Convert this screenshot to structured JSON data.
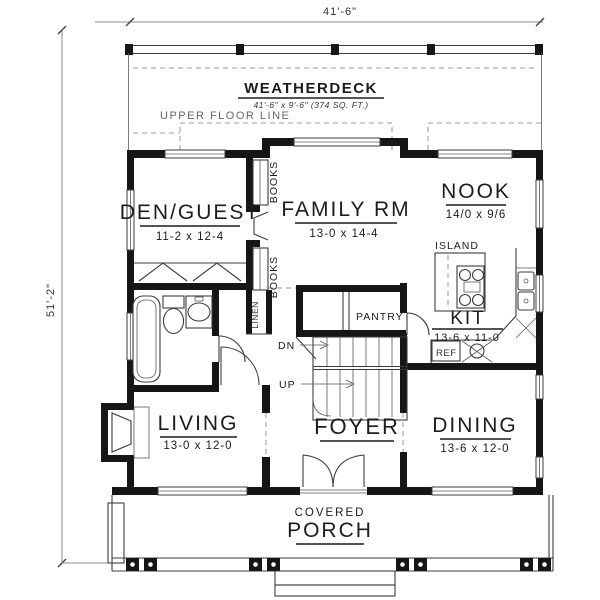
{
  "plan": {
    "dim_width": "41'-6\"",
    "dim_height": "51'-2\"",
    "deck": {
      "title": "WEATHERDECK",
      "size": "41'-6\" x 9'-6\" (374 SQ. FT.)"
    },
    "upper_floor_line": "UPPER FLOOR LINE",
    "rooms": {
      "den": {
        "name": "DEN/GUEST",
        "size": "11-2 x 12-4"
      },
      "family": {
        "name": "FAMILY RM",
        "size": "13-0 x 14-4"
      },
      "nook": {
        "name": "NOOK",
        "size": "14/0 x 9/6"
      },
      "kitchen": {
        "name": "KIT",
        "size": "13-6 x 11-0"
      },
      "living": {
        "name": "LIVING",
        "size": "13-0 x 12-0"
      },
      "foyer": {
        "name": "FOYER"
      },
      "dining": {
        "name": "DINING",
        "size": "13-6 x 12-0"
      },
      "porch": {
        "line1": "COVERED",
        "line2": "PORCH"
      }
    },
    "features": {
      "island": "ISLAND",
      "pantry": "PANTRY",
      "linen": "LINEN",
      "books_upper": "BOOKS",
      "books_lower": "BOOKS",
      "ref": "REF",
      "dn": "DN",
      "up": "UP"
    },
    "colors": {
      "wall": "#161616",
      "line": "#3c3c3c",
      "dashed": "#9a9a9a",
      "background": "#ffffff"
    }
  }
}
